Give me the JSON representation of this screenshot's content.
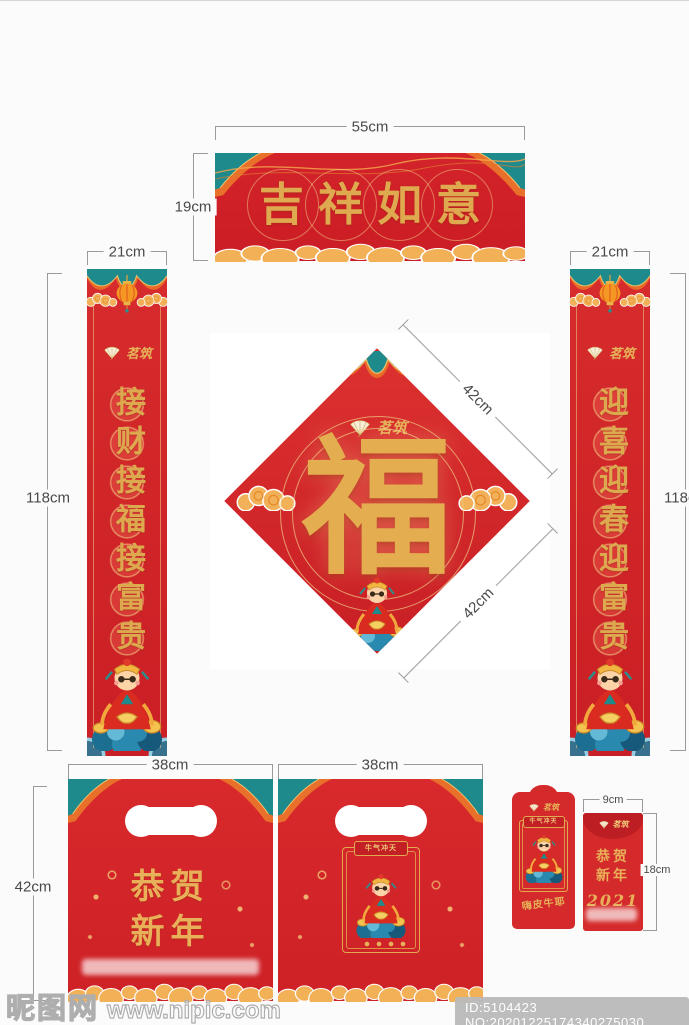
{
  "page": {
    "bg_color": "#fbfbfb",
    "footer": {
      "watermark_site": "昵图网",
      "watermark_url": "www.nipic.com",
      "id_badge": "ID:5104423 NO:20201225174340275030"
    }
  },
  "brand": {
    "name": "茗筑"
  },
  "icons": {
    "brand_icon": "ginkgo-fan-icon",
    "lantern": "lantern-icon",
    "cloud": "gold-cloud-icon",
    "valance": "teal-curtain-valance",
    "figure": "god-of-wealth-illustration"
  },
  "colors": {
    "red": "#d22828",
    "red_deep": "#bd1e23",
    "gold": "#e2ab55",
    "teal": "#1e8a8c",
    "orange": "#ef8b22",
    "dimension_line": "#9a9a9a",
    "dimension_text": "#4a4a4a"
  },
  "banner": {
    "text": "吉祥如意",
    "width_label": "55cm",
    "height_label": "19cm"
  },
  "couplet_left": {
    "text": "接财接福接富贵",
    "width_label": "21cm",
    "height_label": "118cm"
  },
  "couplet_right": {
    "text": "迎喜迎春迎富贵",
    "width_label": "21cm",
    "height_label": "118cm"
  },
  "center_square": {
    "character": "福",
    "edge_label_top": "42cm",
    "edge_label_bottom": "42cm"
  },
  "bag1": {
    "greeting": "恭贺新年",
    "width_label": "38cm",
    "height_label": "42cm"
  },
  "bag2": {
    "frame_title": "牛气冲天",
    "width_label": "38cm"
  },
  "envelope_back": {
    "frame_title": "牛气冲天",
    "greeting": "嗨皮牛耶"
  },
  "envelope_front": {
    "greeting": "恭贺新年",
    "year": "2021",
    "width_label": "9cm",
    "height_label": "18cm"
  }
}
